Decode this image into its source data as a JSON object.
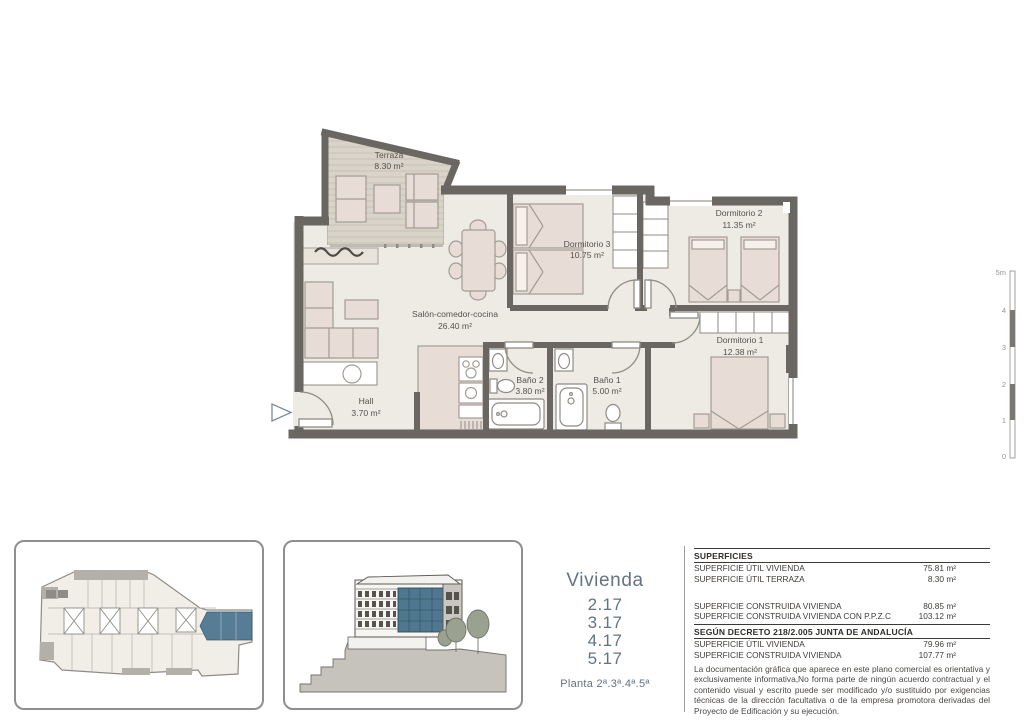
{
  "floor_plan": {
    "rooms": [
      {
        "name": "Terraza",
        "area": "8.30 m²"
      },
      {
        "name": "Dormitorio 3",
        "area": "10.75 m²"
      },
      {
        "name": "Dormitorio 2",
        "area": "11.35 m²"
      },
      {
        "name": "Salón-comedor-cocina",
        "area": "26.40 m²"
      },
      {
        "name": "Dormitorio 1",
        "area": "12.38 m²"
      },
      {
        "name": "Baño 2",
        "area": "3.80 m²"
      },
      {
        "name": "Baño 1",
        "area": "5.00 m²"
      },
      {
        "name": "Hall",
        "area": "3.70 m²"
      }
    ],
    "scale_bar": {
      "labels": [
        "5m",
        "4",
        "3",
        "2",
        "1",
        "0"
      ]
    }
  },
  "unit_info": {
    "title": "Vivienda",
    "units": [
      "2.17",
      "3.17",
      "4.17",
      "5.17"
    ],
    "floor_label": "Planta 2ª.3ª.4ª.5ª"
  },
  "surfaces": {
    "title": "SUPERFICIES",
    "rows": [
      {
        "label": "SUPERFICIE ÚTIL VIVIENDA",
        "value": "75.81 m²"
      },
      {
        "label": "SUPERFICIE ÚTIL TERRAZA",
        "value": "8.30 m²"
      },
      {
        "label": "SUPERFICIE CONSTRUIDA VIVIENDA",
        "value": "80.85 m²"
      },
      {
        "label": "SUPERFICIE CONSTRUIDA VIVIENDA CON P.P.Z.C",
        "value": "103.12 m²"
      }
    ],
    "decree_title": "SEGÚN DECRETO 218/2.005 JUNTA DE ANDALUCÍA",
    "decree_rows": [
      {
        "label": "SUPERFICIE ÚTIL VIVIENDA",
        "value": "79.96 m²"
      },
      {
        "label": "SUPERFICIE CONSTRUIDA VIVIENDA",
        "value": "107.77 m²"
      }
    ],
    "disclaimer": "La documentación gráfica que aparece en este plano comercial es orientativa y exclusivamente informativa,No forma parte de ningún acuerdo contractual y el contenido visual y escrito puede ser modificado y/o sustituido por exigencias técnicas de la dirección facultativa o de la empresa promotora derivadas del Proyecto de Edificación y su ejecución."
  },
  "colors": {
    "wall": "#6a6763",
    "floor": "#edebe4",
    "furniture": "#e8ddd6",
    "deck": "#d9d4ca",
    "accent_blue": "#567c96",
    "glass_blue": "#4f7890",
    "title_text": "#64737f",
    "table_text": "#3f3c38"
  }
}
